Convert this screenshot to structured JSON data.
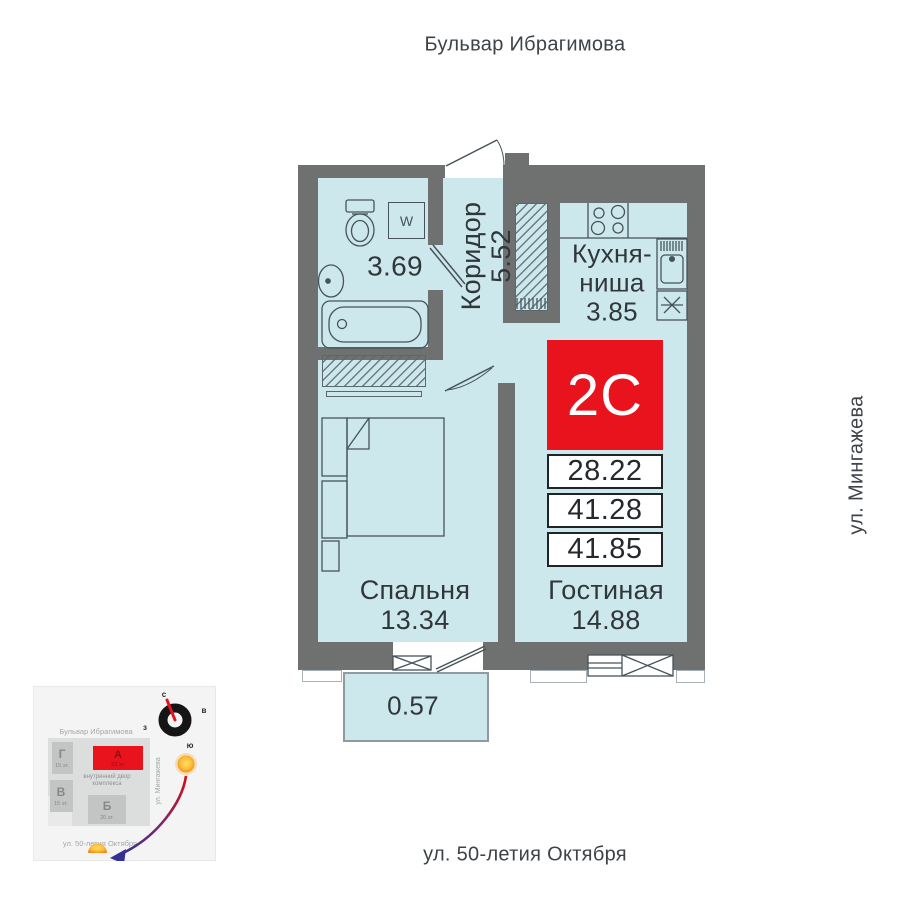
{
  "streets": {
    "top": "Бульвар Ибрагимова",
    "right": "ул. Мингажева",
    "bottom": "ул. 50-летия Октября"
  },
  "apartment": {
    "code": "2C",
    "rows": [
      "28.22",
      "41.28",
      "41.85"
    ]
  },
  "rooms": {
    "bathroom": {
      "area": "3.69"
    },
    "corridor": {
      "name": "Коридор",
      "area": "5.52"
    },
    "kitchen": {
      "line1": "Кухня-",
      "line2": "ниша",
      "area": "3.85"
    },
    "bedroom": {
      "name": "Спальня",
      "area": "13.34"
    },
    "living": {
      "name": "Гостиная",
      "area": "14.88"
    },
    "balcony": {
      "area": "0.57"
    },
    "washer_label": "W"
  },
  "minimap": {
    "compass": {
      "n": "с",
      "e": "в",
      "w": "з",
      "s": "ю"
    },
    "street_top": "Бульвар Ибрагимова",
    "street_right": "ул. Мингажева",
    "street_bottom": "ул. 50-летия Октября",
    "courtyard_line1": "внутренний двор",
    "courtyard_line2": "комплекса",
    "buildings": {
      "g": {
        "label": "Г",
        "floors": "15 эт."
      },
      "a": {
        "label": "А",
        "floors": "33 эт."
      },
      "v": {
        "label": "В",
        "floors": "15 эт."
      },
      "b": {
        "label": "Б",
        "floors": "20 эт."
      }
    }
  },
  "colors": {
    "accent_red": "#e8131d",
    "wall_gray": "#6f7070",
    "room_fill": "#cde8ed"
  }
}
